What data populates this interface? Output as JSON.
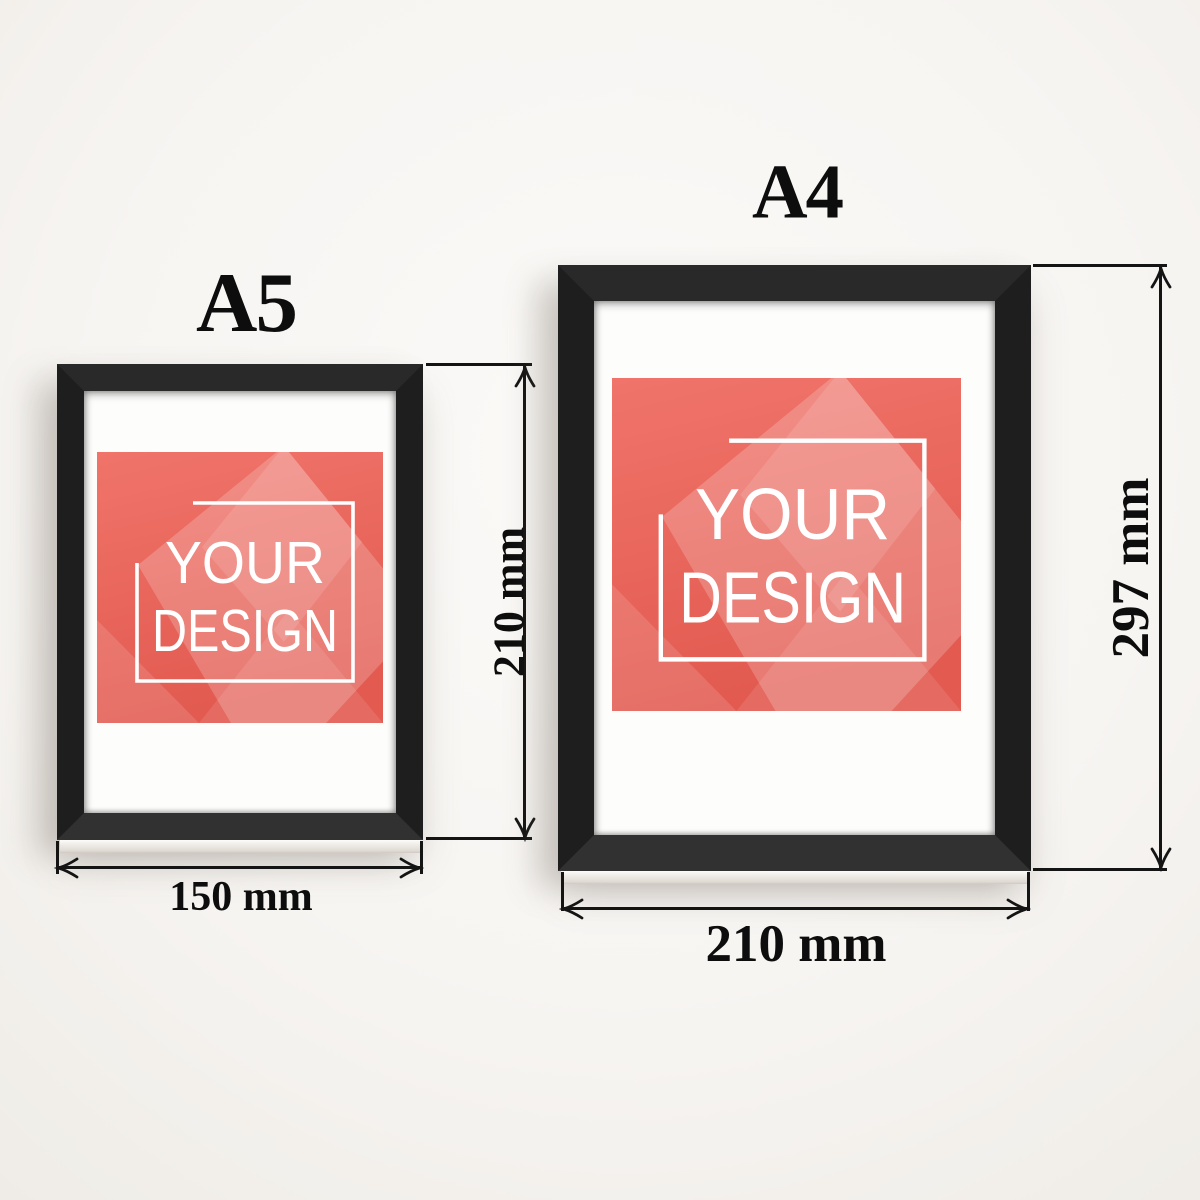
{
  "scene": {
    "description": "Picture frame size comparison diagram",
    "background_color": "#f7f5f2"
  },
  "frames": [
    {
      "id": "a5",
      "title": "A5",
      "width_label": "150 mm",
      "height_label": "210 mm",
      "poster": {
        "line1": "YOUR",
        "line2": "DESIGN"
      }
    },
    {
      "id": "a4",
      "title": "A4",
      "width_label": "210 mm",
      "height_label": "297 mm",
      "poster": {
        "line1": "YOUR",
        "line2": "DESIGN"
      }
    }
  ],
  "colors": {
    "frame_black": "#1e1e1e",
    "mat_white": "#fdfdfc",
    "poster_red_top": "#f0746a",
    "poster_red_bottom": "#e25a50",
    "dimension_line": "#141414",
    "label_text": "#0d0d0d"
  }
}
